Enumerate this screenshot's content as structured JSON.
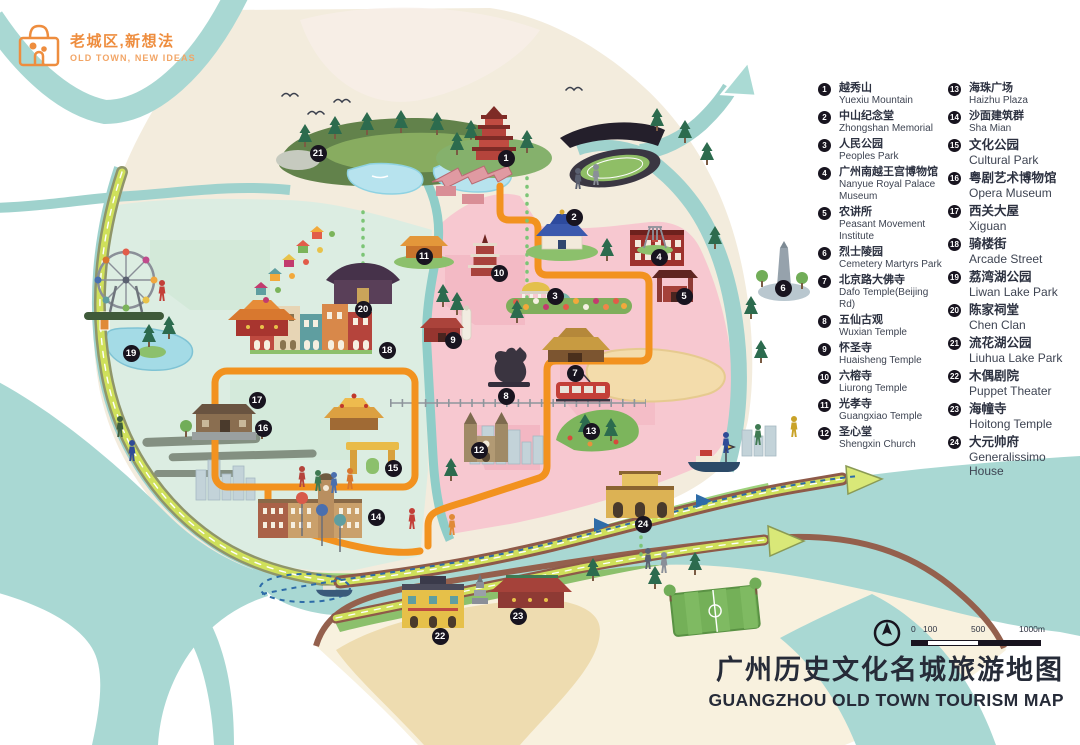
{
  "logo": {
    "zh": "老城区,新想法",
    "en": "OLD TOWN, NEW IDEAS"
  },
  "title": {
    "zh": "广州历史文化名城旅游地图",
    "en": "GUANGZHOU OLD TOWN TOURISM MAP"
  },
  "scale_bar": {
    "labels": [
      "0",
      "100",
      "500",
      "1000m"
    ]
  },
  "colors": {
    "accent_orange": "#f2921f",
    "river_teal": "#a9d8d3",
    "district_pink": "#f7c8d0",
    "district_mint": "#dcede2",
    "greenway": "#cfe05b",
    "legend_text": "#2c3140"
  },
  "legend": {
    "items": [
      {
        "num": 1,
        "zh": "越秀山",
        "en": "Yuexiu Mountain"
      },
      {
        "num": 2,
        "zh": "中山纪念堂",
        "en": "Zhongshan Memorial"
      },
      {
        "num": 3,
        "zh": "人民公园",
        "en": "Peoples Park"
      },
      {
        "num": 4,
        "zh": "广州南越王宫博物馆",
        "en": "Nanyue Royal Palace Museum"
      },
      {
        "num": 5,
        "zh": "农讲所",
        "en": "Peasant Movement Institute"
      },
      {
        "num": 6,
        "zh": "烈士陵园",
        "en": "Cemetery Martyrs Park"
      },
      {
        "num": 7,
        "zh": "北京路大佛寺",
        "en": "Dafo Temple(Beijing Rd)"
      },
      {
        "num": 8,
        "zh": "五仙古观",
        "en": "Wuxian Temple"
      },
      {
        "num": 9,
        "zh": "怀圣寺",
        "en": "Huaisheng Temple"
      },
      {
        "num": 10,
        "zh": "六榕寺",
        "en": "Liurong Temple"
      },
      {
        "num": 11,
        "zh": "光孝寺",
        "en": "Guangxiao Temple"
      },
      {
        "num": 12,
        "zh": "圣心堂",
        "en": "Shengxin Church"
      },
      {
        "num": 13,
        "zh": "海珠广场",
        "en": "Haizhu Plaza"
      },
      {
        "num": 14,
        "zh": "沙面建筑群",
        "en": "Sha Mian"
      },
      {
        "num": 15,
        "zh": "文化公园",
        "en": "Cultural Park"
      },
      {
        "num": 16,
        "zh": "粤剧艺术博物馆",
        "en": "Opera Museum"
      },
      {
        "num": 17,
        "zh": "西关大屋",
        "en": "Xiguan"
      },
      {
        "num": 18,
        "zh": "骑楼街",
        "en": "Arcade Street"
      },
      {
        "num": 19,
        "zh": "荔湾湖公园",
        "en": "Liwan Lake Park"
      },
      {
        "num": 20,
        "zh": "陈家祠堂",
        "en": "Chen Clan"
      },
      {
        "num": 21,
        "zh": "流花湖公园",
        "en": "Liuhua Lake Park"
      },
      {
        "num": 22,
        "zh": "木偶剧院",
        "en": "Puppet Theater"
      },
      {
        "num": 23,
        "zh": "海幢寺",
        "en": "Hoitong Temple"
      },
      {
        "num": 24,
        "zh": "大元帅府",
        "en": "Generalissimo House"
      }
    ]
  },
  "map": {
    "markers": [
      {
        "num": 1,
        "x": 506,
        "y": 158
      },
      {
        "num": 2,
        "x": 574,
        "y": 217
      },
      {
        "num": 3,
        "x": 555,
        "y": 296
      },
      {
        "num": 4,
        "x": 659,
        "y": 257
      },
      {
        "num": 5,
        "x": 684,
        "y": 296
      },
      {
        "num": 6,
        "x": 783,
        "y": 288
      },
      {
        "num": 7,
        "x": 575,
        "y": 373
      },
      {
        "num": 8,
        "x": 506,
        "y": 396
      },
      {
        "num": 9,
        "x": 453,
        "y": 340
      },
      {
        "num": 10,
        "x": 499,
        "y": 273
      },
      {
        "num": 11,
        "x": 424,
        "y": 256
      },
      {
        "num": 12,
        "x": 479,
        "y": 450
      },
      {
        "num": 13,
        "x": 591,
        "y": 431
      },
      {
        "num": 14,
        "x": 376,
        "y": 517
      },
      {
        "num": 15,
        "x": 393,
        "y": 468
      },
      {
        "num": 16,
        "x": 263,
        "y": 428
      },
      {
        "num": 17,
        "x": 257,
        "y": 400
      },
      {
        "num": 18,
        "x": 387,
        "y": 350
      },
      {
        "num": 19,
        "x": 131,
        "y": 353
      },
      {
        "num": 20,
        "x": 363,
        "y": 309
      },
      {
        "num": 21,
        "x": 318,
        "y": 153
      },
      {
        "num": 22,
        "x": 440,
        "y": 636
      },
      {
        "num": 23,
        "x": 518,
        "y": 616
      },
      {
        "num": 24,
        "x": 643,
        "y": 524
      }
    ]
  }
}
